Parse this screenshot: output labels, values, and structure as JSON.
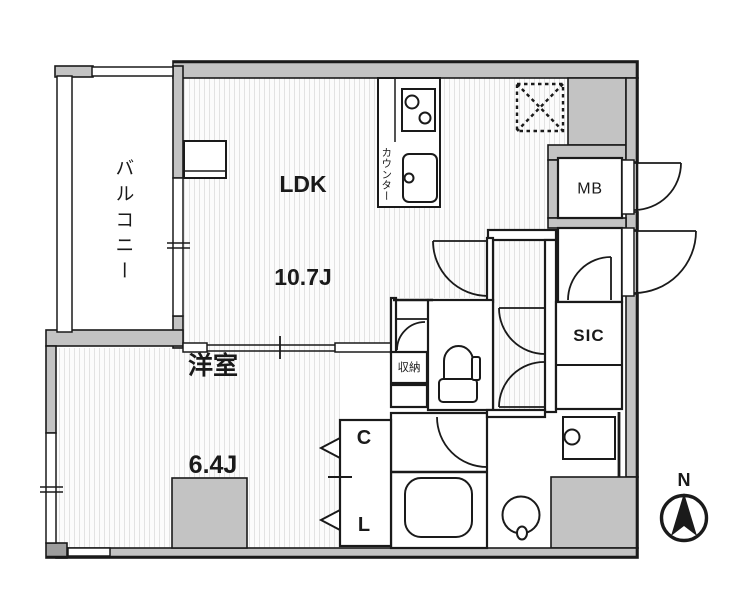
{
  "rooms": {
    "balcony": "バルコニー",
    "ldk_name": "LDK",
    "ldk_size": "10.7J",
    "western_name": "洋室",
    "western_size": "6.4J",
    "closet_line1": "C",
    "closet_line2": "L",
    "meter_box": "MB",
    "shoe_closet": "SIC",
    "storage": "収納",
    "kitchen_counter": "カウンター"
  },
  "compass": {
    "north": "N"
  },
  "colors": {
    "wall_fill": "#c3c3c3",
    "outline": "#1a1a1a",
    "floor": "#fcfcfc",
    "floor_stripe": "#e3e3e3"
  }
}
